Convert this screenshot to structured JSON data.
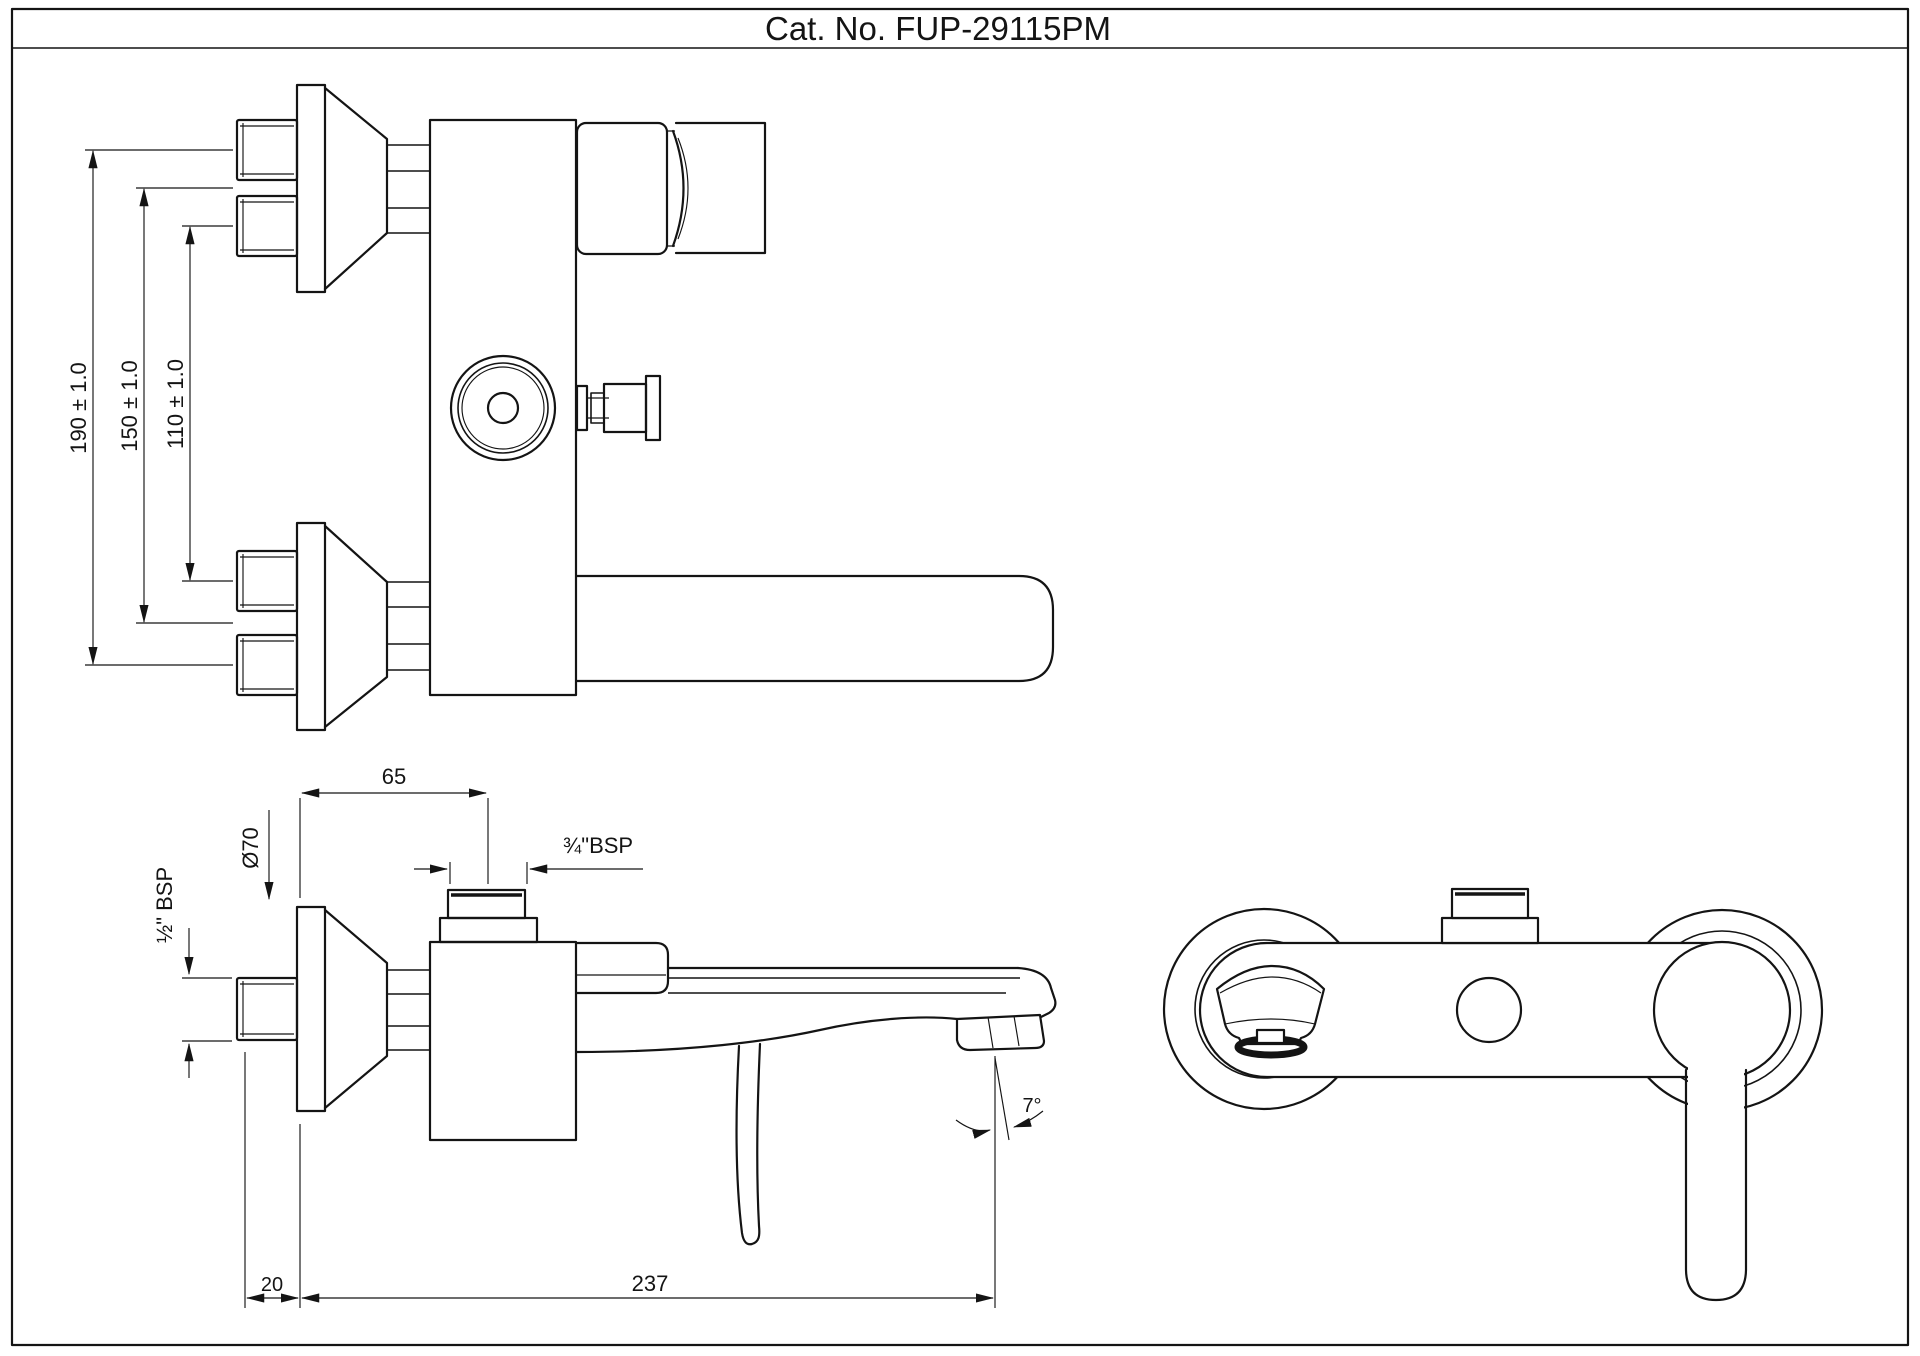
{
  "labels": {
    "title": "Cat. No. FUP-29115PM",
    "dim190": "190 ± 1.0",
    "dim150": "150 ± 1.0",
    "dim110": "110 ± 1.0",
    "dim65": "65",
    "dia70": "Ø70",
    "bsp_half": "½\" BSP",
    "bsp_three_quarters": "¾\"BSP",
    "dim20": "20",
    "dim237": "237",
    "angle7": "7°"
  },
  "colors": {
    "line": "#141414",
    "background": "#ffffff"
  }
}
